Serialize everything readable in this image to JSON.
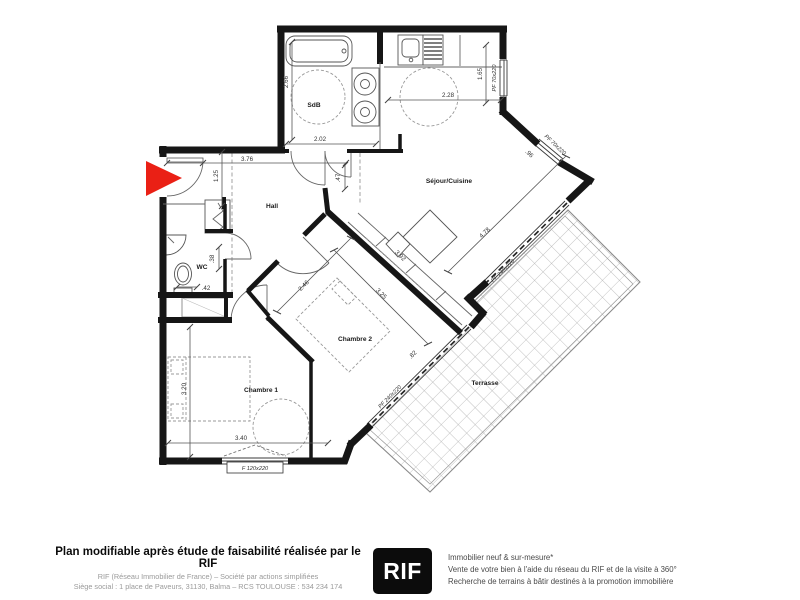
{
  "plan": {
    "rooms": {
      "sdb": "SdB",
      "sejour": "Séjour/Cuisine",
      "hall": "Hall",
      "wc": "WC",
      "chambre1": "Chambre 1",
      "chambre2": "Chambre 2",
      "terrasse": "Terrasse"
    },
    "dimensions": {
      "sdb_depth": "2.66",
      "sdb_width": "2.02",
      "kitchen_width": "2.28",
      "kitchen_depth": "1.65",
      "hall_length": "3.76",
      "hall_width": "1.25",
      "sejour_door": ".47",
      "wc_width": ".38",
      "wc_depth": ".42",
      "ch2_width": "2.46",
      "ch2_length": "3.25",
      "sejour_depth": "3.92",
      "sejour_facade": "4.78",
      "kitchen_win": ".96",
      "ch2_jog": ".82",
      "ch1_depth": "3.20",
      "ch1_width": "3.40"
    },
    "windows": {
      "kitchen_right": "PF 70x220",
      "kitchen_diag": "PF 70x220",
      "sejour_bay": "PF 240x220",
      "ch2_bay": "PF 240x220",
      "ch1_window": "F 120x220"
    }
  },
  "footer": {
    "title": "Plan modifiable après étude de faisabilité réalisée par le RIF",
    "company_line": "RIF (Réseau Immobilier de France) – Société par actions simplifiées",
    "address_line": "Siège social : 1 place de Paveurs, 31130, Balma – RCS TOULOUSE : 534 234 174",
    "logo": "RIF",
    "right_line1": "Immobilier neuf & sur-mesure*",
    "right_line2": "Vente de votre bien à l'aide du réseau du RIF et de la visite à 360°",
    "right_line3": "Recherche de terrains à bâtir destinés à la promotion immobilière"
  },
  "colors": {
    "entrance_arrow": "#ea2015",
    "wall": "#161616"
  }
}
